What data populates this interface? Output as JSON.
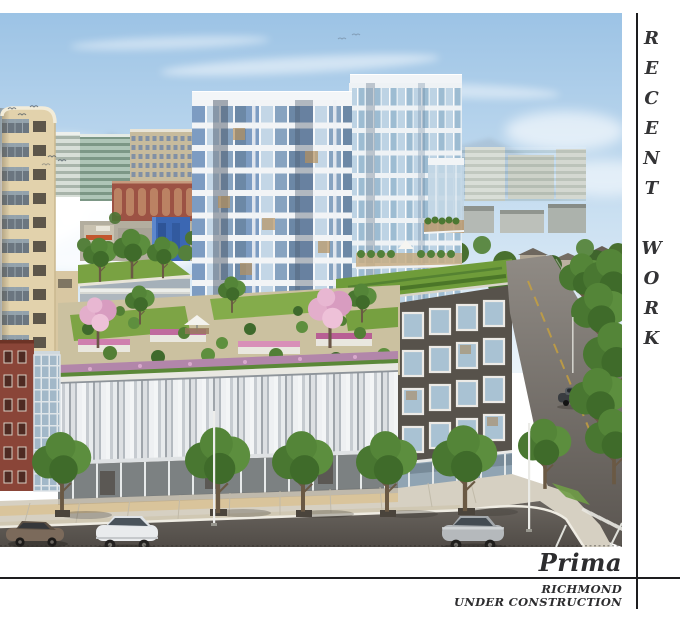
{
  "page": {
    "background": "#ffffff",
    "rule_color": "#1d1d1f",
    "text_color": "#2d2d2f"
  },
  "sidebar": {
    "label": "RECENT WORK"
  },
  "project": {
    "name": "Prima",
    "location": "RICHMOND",
    "status": "UNDER CONSTRUCTION"
  },
  "rendering": {
    "subject": "prima-mixed-use-building-rendering",
    "palette": {
      "sky": "#9cc3e5",
      "tower_white": "#f2f4f6",
      "glass_blue": "#7d9cc2",
      "cream_building": "#e2d2ac",
      "green_roof": "#79a242",
      "dark_facade": "#57524b",
      "louver_silver": "#e8ebed",
      "asphalt": "#57524d",
      "blossom_pink": "#d89cc0"
    }
  }
}
